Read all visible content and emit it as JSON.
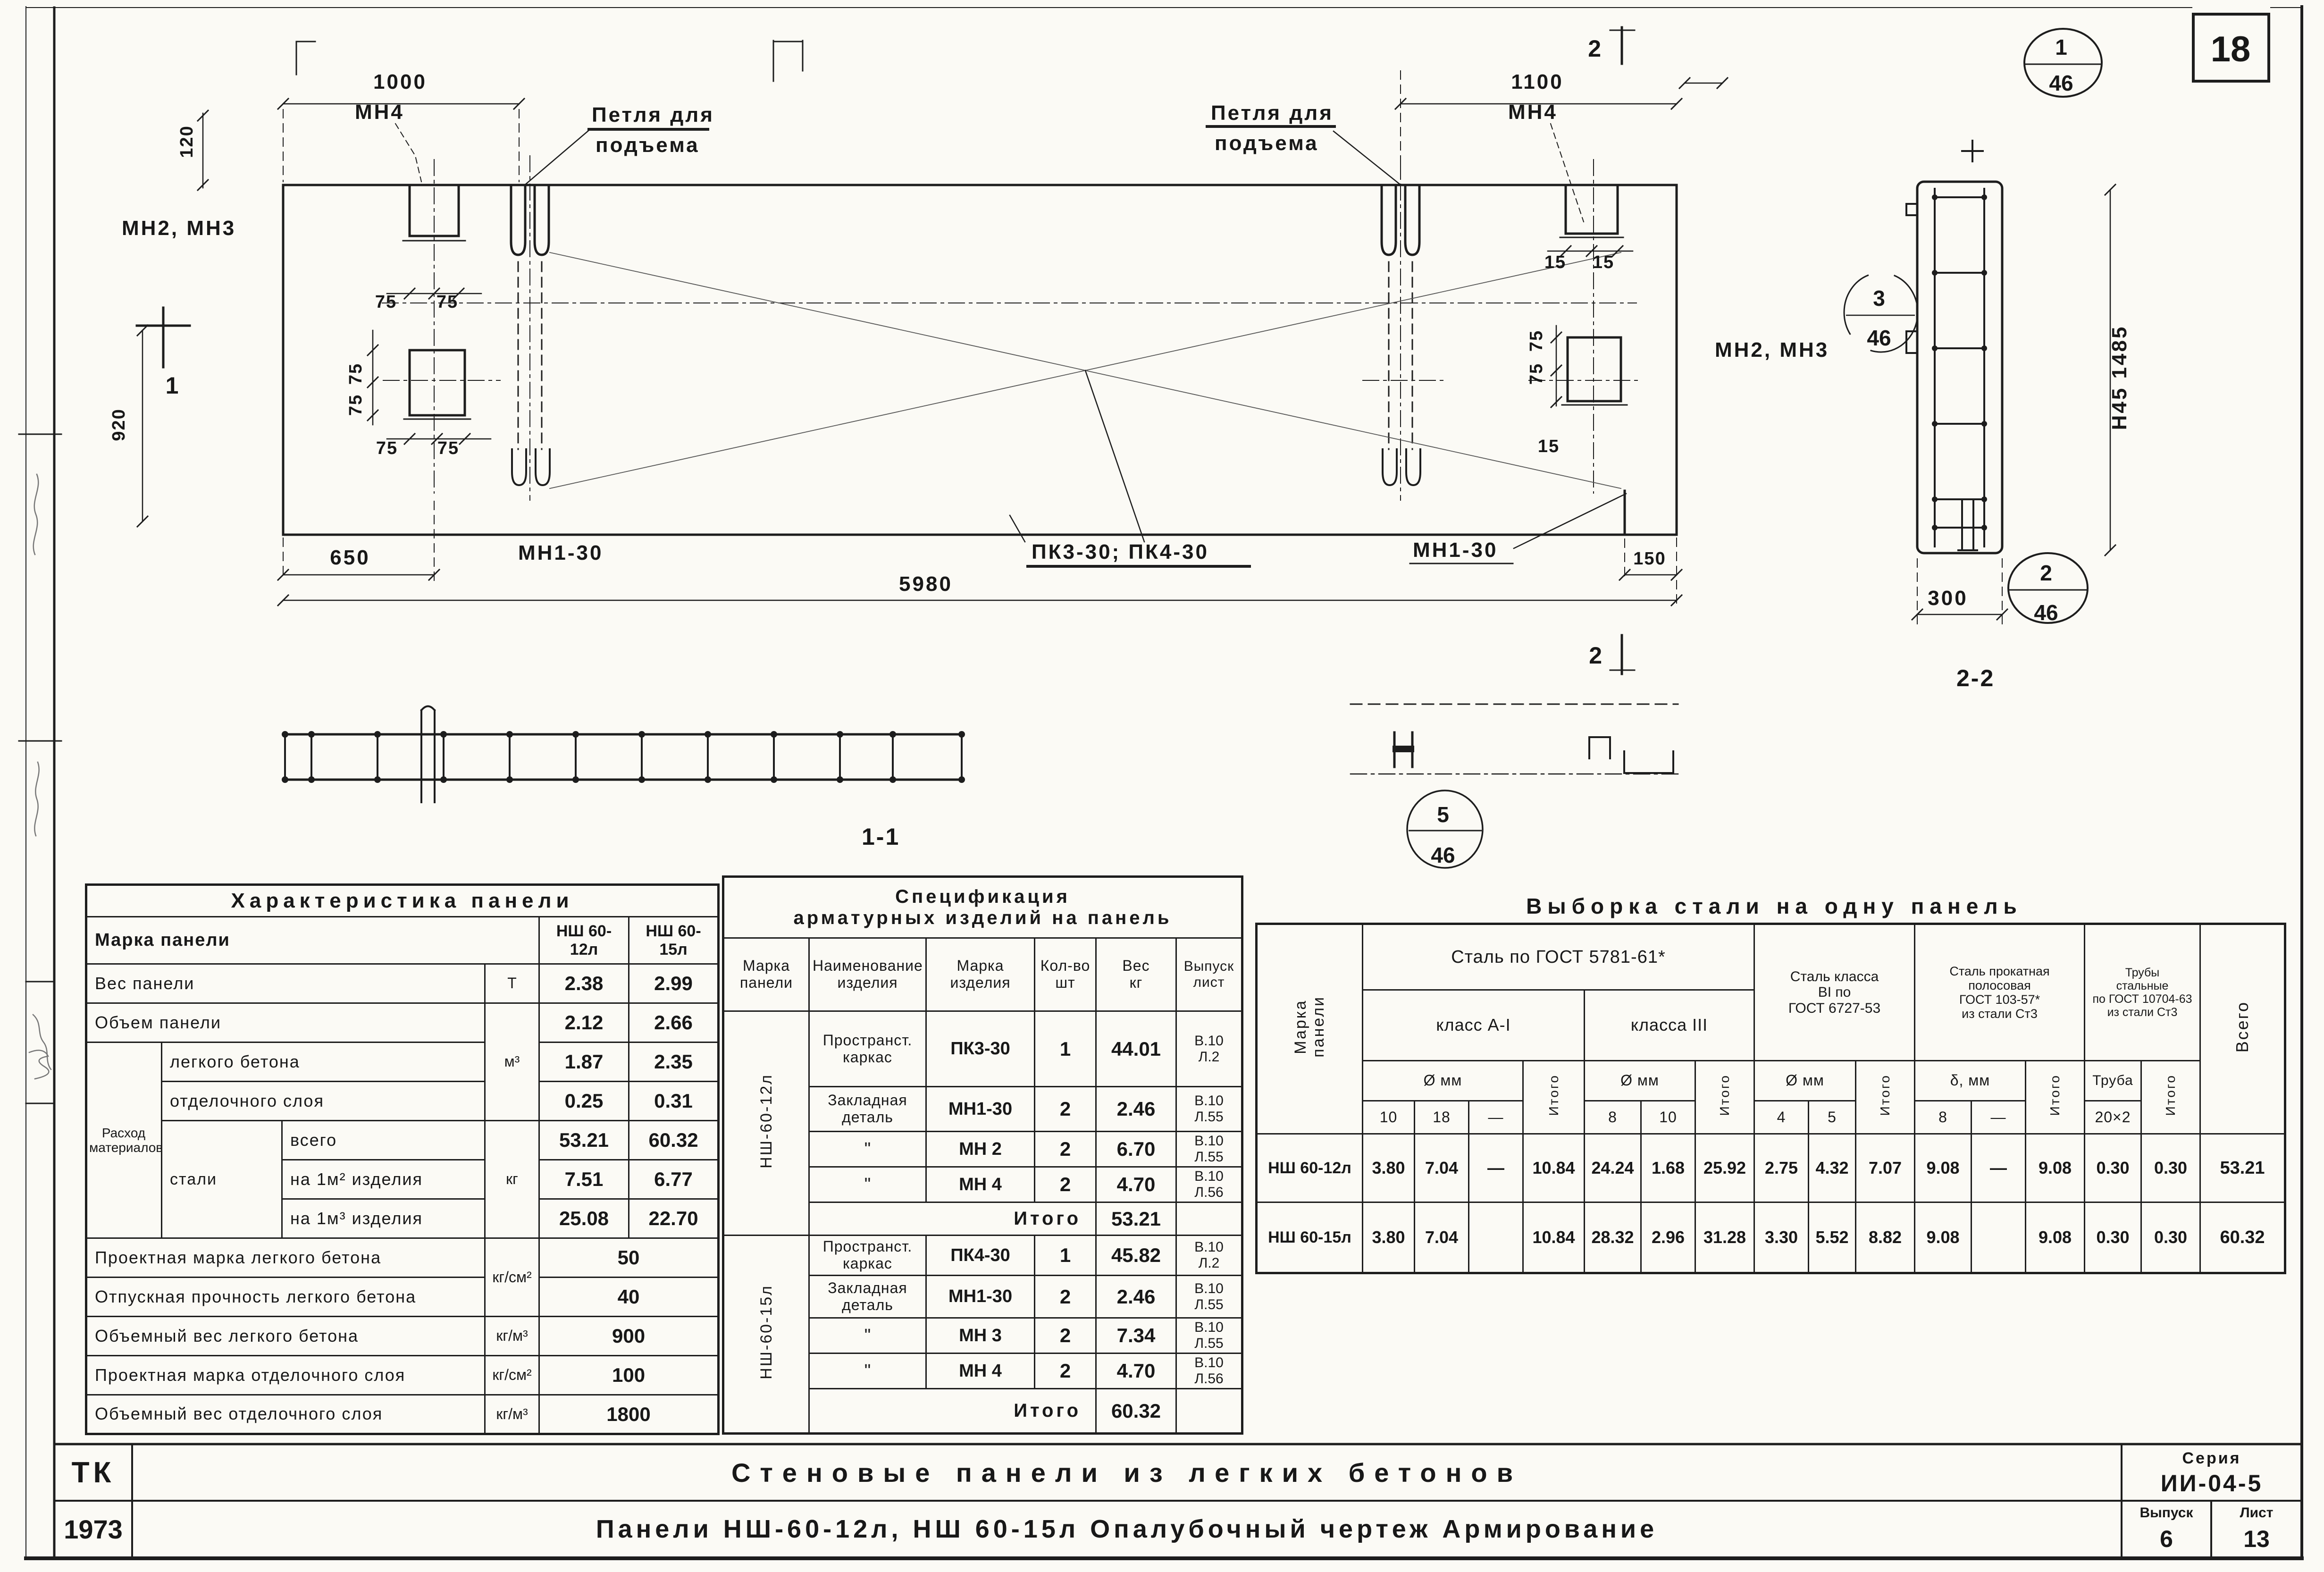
{
  "page": {
    "sheet_number": "18"
  },
  "drawing": {
    "dims": {
      "d1000": "1000",
      "d1100": "1100",
      "d120": "120",
      "d920": "920",
      "d650": "650",
      "d5980": "5980",
      "d150": "150",
      "d300": "300",
      "d75": "75",
      "d15": "15",
      "height_dim": "Н45  1485"
    },
    "labels": {
      "mn4": "МН4",
      "mn2_mn3": "МН2, МН3",
      "loop_line1": "Петля для",
      "loop_line2": "подъема",
      "mn1_30": "МН1-30",
      "pk": "ПК3-30; ПК4-30",
      "section1": "1",
      "section2": "2",
      "view11": "1-1",
      "view22": "2-2"
    },
    "bubbles": {
      "b1": {
        "top": "1",
        "bottom": "46"
      },
      "b2": {
        "top": "2",
        "bottom": "46"
      },
      "b3": {
        "top": "3",
        "bottom": "46"
      },
      "b5": {
        "top": "5",
        "bottom": "46"
      }
    }
  },
  "char_table": {
    "title": "Характеристика панели",
    "mark": {
      "label": "Марка панели",
      "v1": "НШ 60-12л",
      "v2": "НШ 60-15л"
    },
    "weight": {
      "label": "Вес панели",
      "unit": "Т",
      "v1": "2.38",
      "v2": "2.99"
    },
    "volume": {
      "label": "Объем панели",
      "unit": "м³",
      "v1": "2.12",
      "v2": "2.66"
    },
    "consumption_label": "Расход\nматериалов",
    "concrete": {
      "label": "легкого бетона",
      "v1": "1.87",
      "v2": "2.35"
    },
    "finish": {
      "label": "отделочного слоя",
      "v1": "0.25",
      "v2": "0.31"
    },
    "steel_label": "стали",
    "steel_unit": "кг",
    "steel_total": {
      "label": "всего",
      "v1": "53.21",
      "v2": "60.32"
    },
    "steel_m2": {
      "label": "на 1м² изделия",
      "v1": "7.51",
      "v2": "6.77"
    },
    "steel_m3": {
      "label": "на 1м³ изделия",
      "v1": "25.08",
      "v2": "22.70"
    },
    "bottom": [
      {
        "label": "Проектная марка легкого бетона",
        "unit": "кг/см²",
        "value": "50"
      },
      {
        "label": "Отпускная прочность легкого бетона",
        "unit": "",
        "value": "40"
      },
      {
        "label": "Объемный вес легкого бетона",
        "unit": "кг/м³",
        "value": "900"
      },
      {
        "label": "Проектная марка отделочного слоя",
        "unit": "кг/см²",
        "value": "100"
      },
      {
        "label": "Объемный вес отделочного слоя",
        "unit": "кг/м³",
        "value": "1800"
      }
    ]
  },
  "spec_table": {
    "title": "Спецификация\nарматурных изделий на панель",
    "headers": {
      "mark_panel": "Марка\nпанели",
      "name": "Наименование\nизделия",
      "mark_item": "Марка\nизделия",
      "qty": "Кол-во\nшт",
      "weight": "Вес\nкг",
      "issue": "Выпуск\nлист"
    },
    "g1": {
      "mark": "НШ-60-12л",
      "rows": [
        {
          "name": "Пространст.\nкаркас",
          "mark": "ПК3-30",
          "qty": "1",
          "weight": "44.01",
          "issue": "В.10\nЛ.2"
        },
        {
          "name": "Закладная\nдеталь",
          "mark": "МН1-30",
          "qty": "2",
          "weight": "2.46",
          "issue": "В.10\nЛ.55"
        },
        {
          "name": "\"",
          "mark": "МН 2",
          "qty": "2",
          "weight": "6.70",
          "issue": "В.10\nЛ.55"
        },
        {
          "name": "\"",
          "mark": "МН 4",
          "qty": "2",
          "weight": "4.70",
          "issue": "В.10\nЛ.56"
        }
      ],
      "total_label": "Итого",
      "total": "53.21"
    },
    "g2": {
      "mark": "НШ-60-15л",
      "rows": [
        {
          "name": "Пространст.\nкаркас",
          "mark": "ПК4-30",
          "qty": "1",
          "weight": "45.82",
          "issue": "В.10\nЛ.2"
        },
        {
          "name": "Закладная\nдеталь",
          "mark": "МН1-30",
          "qty": "2",
          "weight": "2.46",
          "issue": "В.10\nЛ.55"
        },
        {
          "name": "\"",
          "mark": "МН 3",
          "qty": "2",
          "weight": "7.34",
          "issue": "В.10\nЛ.55"
        },
        {
          "name": "\"",
          "mark": "МН 4",
          "qty": "2",
          "weight": "4.70",
          "issue": "В.10\nЛ.56"
        }
      ],
      "total_label": "Итого",
      "total": "60.32"
    }
  },
  "steel_table": {
    "title": "Выборка стали на одну панель",
    "col_mark": "Марка\nпанели",
    "group_gost5781": "Сталь по ГОСТ 5781-61*",
    "class_a1": "класс А-I",
    "class_a3": "класса III",
    "group_b1": "Сталь класса\nВI по\nГОСТ 6727-53",
    "group_strip": "Сталь прокатная\nполосовая\nГОСТ 103-57*\nиз стали Ст3",
    "group_pipe": "Трубы\nстальные\nпо ГОСТ 10704-63\nиз стали Ст3",
    "col_total": "Всего",
    "dia": "Ø мм",
    "delta": "δ, мм",
    "pipe_col": "Труба",
    "itogo": "Итого",
    "sub": [
      "10",
      "18",
      "—",
      "8",
      "10",
      "4",
      "5",
      "8",
      "—",
      "20×2"
    ],
    "rows": [
      {
        "mark": "НШ 60-12л",
        "a1": "3.80",
        "a2": "7.04",
        "a3": "—",
        "a_t": "10.84",
        "b1": "24.24",
        "b2": "1.68",
        "b_t": "25.92",
        "c1": "2.75",
        "c2": "4.32",
        "c_t": "7.07",
        "d1": "9.08",
        "d2": "—",
        "d_t": "9.08",
        "e1": "0.30",
        "e_t": "0.30",
        "total": "53.21"
      },
      {
        "mark": "НШ 60-15л",
        "a1": "3.80",
        "a2": "7.04",
        "a3": "",
        "a_t": "10.84",
        "b1": "28.32",
        "b2": "2.96",
        "b_t": "31.28",
        "c1": "3.30",
        "c2": "5.52",
        "c_t": "8.82",
        "d1": "9.08",
        "d2": "",
        "d_t": "9.08",
        "e1": "0.30",
        "e_t": "0.30",
        "total": "60.32"
      }
    ]
  },
  "title_block": {
    "org": "ТК",
    "year": "1973",
    "row1": "Стеновые панели из легких бетонов",
    "row2": "Панели НШ-60-12л, НШ 60-15л   Опалубочный чертеж   Армирование",
    "series_label": "Серия",
    "series": "ИИ-04-5",
    "issue_label": "Выпуск",
    "issue": "6",
    "sheet_label": "Лист",
    "sheet": "13"
  }
}
